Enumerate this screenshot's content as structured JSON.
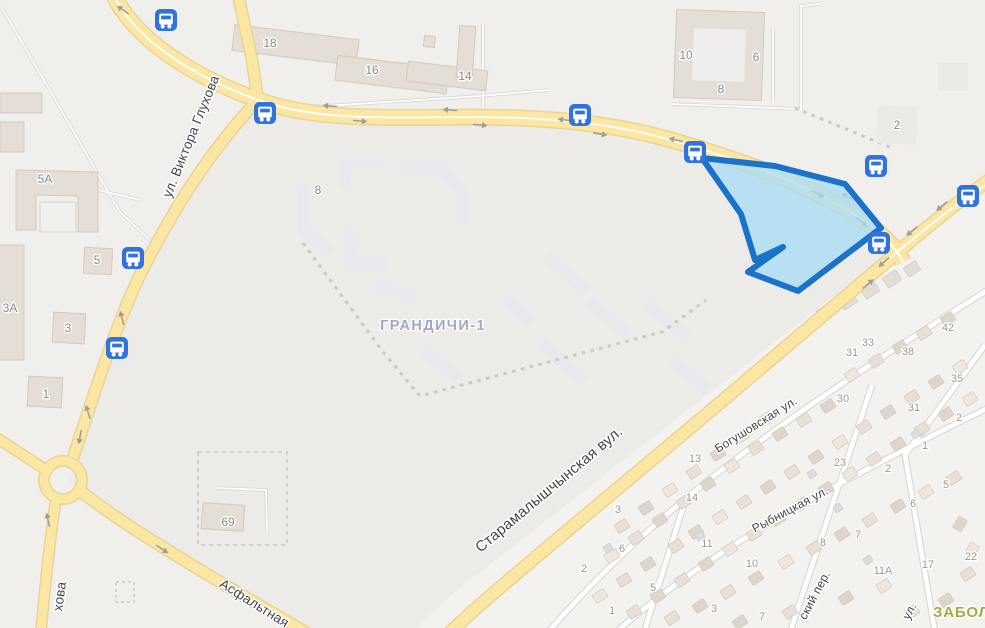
{
  "map": {
    "district_labels": [
      {
        "text": "ГРАНДИЧИ-1",
        "x": 433,
        "y": 330,
        "rotate": 0,
        "kind": "district"
      },
      {
        "text": "ЗАБОЛ",
        "x": 933,
        "y": 617,
        "rotate": 0,
        "kind": "district-green"
      }
    ],
    "street_labels": [
      {
        "text": "ул. Виктора Глухова",
        "x": 195,
        "y": 138,
        "rotate": -68,
        "size": 13.5
      },
      {
        "text": "хова",
        "x": 64,
        "y": 597,
        "rotate": -82,
        "size": 13.5
      },
      {
        "text": "Асфальтная",
        "x": 252,
        "y": 607,
        "rotate": 32,
        "size": 13.5
      },
      {
        "text": "Старамалышчынская вул.",
        "x": 552,
        "y": 493,
        "rotate": -40,
        "size": 15
      },
      {
        "text": "Богушовская ул.",
        "x": 758,
        "y": 428,
        "rotate": -32,
        "size": 12
      },
      {
        "text": "Рыбницкая ул.",
        "x": 792,
        "y": 513,
        "rotate": -28,
        "size": 12
      },
      {
        "text": "ский пер.",
        "x": 818,
        "y": 597,
        "rotate": -62,
        "size": 12
      },
      {
        "text": "ул.",
        "x": 913,
        "y": 613,
        "rotate": -62,
        "size": 12
      }
    ],
    "building_numbers": [
      [
        270,
        43,
        "18"
      ],
      [
        372,
        70,
        "16"
      ],
      [
        465,
        76,
        "14"
      ],
      [
        686,
        55,
        "10"
      ],
      [
        756,
        57,
        "6"
      ],
      [
        721,
        89,
        "8"
      ],
      [
        897,
        125,
        "2"
      ],
      [
        318,
        190,
        "8"
      ],
      [
        45,
        179,
        "5А"
      ],
      [
        97,
        260,
        "5"
      ],
      [
        10,
        308,
        "3А"
      ],
      [
        68,
        328,
        "3"
      ],
      [
        46,
        394,
        "1"
      ],
      [
        228,
        522,
        "69"
      ]
    ],
    "house_numbers": [
      [
        618,
        509,
        "3"
      ],
      [
        695,
        458,
        "13"
      ],
      [
        692,
        497,
        "14"
      ],
      [
        707,
        543,
        "11"
      ],
      [
        622,
        548,
        "6"
      ],
      [
        584,
        568,
        "2"
      ],
      [
        653,
        587,
        "5"
      ],
      [
        612,
        610,
        "1"
      ],
      [
        752,
        563,
        "10"
      ],
      [
        714,
        608,
        "3"
      ],
      [
        762,
        616,
        "7"
      ],
      [
        948,
        327,
        "42"
      ],
      [
        868,
        342,
        "33"
      ],
      [
        852,
        352,
        "31"
      ],
      [
        908,
        351,
        "38"
      ],
      [
        957,
        378,
        "35"
      ],
      [
        843,
        398,
        "30"
      ],
      [
        914,
        407,
        "31"
      ],
      [
        840,
        462,
        "23"
      ],
      [
        959,
        417,
        "2"
      ],
      [
        925,
        445,
        "1"
      ],
      [
        888,
        468,
        "2"
      ],
      [
        823,
        542,
        "8"
      ],
      [
        858,
        534,
        "7"
      ],
      [
        883,
        570,
        "11А"
      ],
      [
        928,
        564,
        "17"
      ],
      [
        971,
        556,
        "22"
      ],
      [
        946,
        484,
        "5"
      ],
      [
        913,
        503,
        "6"
      ]
    ],
    "bus_stops": [
      [
        166,
        20
      ],
      [
        265,
        113
      ],
      [
        580,
        115
      ],
      [
        695,
        152
      ],
      [
        876,
        166
      ],
      [
        968,
        196
      ],
      [
        879,
        243
      ],
      [
        133,
        258
      ],
      [
        117,
        348
      ]
    ],
    "lane_arrows": [
      [
        330,
        106,
        184
      ],
      [
        450,
        110,
        184
      ],
      [
        565,
        120,
        187
      ],
      [
        676,
        140,
        193
      ],
      [
        790,
        170,
        202
      ],
      [
        848,
        197,
        210
      ],
      [
        360,
        121,
        5
      ],
      [
        480,
        125,
        6
      ],
      [
        600,
        134,
        10
      ],
      [
        712,
        159,
        15
      ],
      [
        818,
        194,
        28
      ],
      [
        862,
        222,
        40
      ],
      [
        942,
        206,
        140
      ],
      [
        912,
        231,
        140
      ],
      [
        884,
        262,
        138
      ],
      [
        868,
        284,
        -40
      ],
      [
        122,
        318,
        255
      ],
      [
        88,
        412,
        253
      ],
      [
        162,
        549,
        33
      ],
      [
        123,
        10,
        215
      ],
      [
        80,
        437,
        100
      ],
      [
        48,
        520,
        258
      ]
    ],
    "houses": [
      [
        622,
        526
      ],
      [
        646,
        508
      ],
      [
        670,
        490
      ],
      [
        694,
        472
      ],
      [
        718,
        454
      ],
      [
        742,
        436
      ],
      [
        766,
        419
      ],
      [
        612,
        556
      ],
      [
        636,
        538
      ],
      [
        660,
        520
      ],
      [
        684,
        502
      ],
      [
        708,
        484
      ],
      [
        732,
        466
      ],
      [
        756,
        448
      ],
      [
        780,
        434
      ],
      [
        804,
        420
      ],
      [
        828,
        406
      ],
      [
        826,
        312,
        -33,
        16,
        12,
        3
      ],
      [
        848,
        301,
        -33,
        16,
        12,
        3
      ],
      [
        870,
        290,
        -33,
        16,
        12,
        3
      ],
      [
        892,
        279,
        -33,
        16,
        12,
        3
      ],
      [
        912,
        269,
        -33,
        14,
        11,
        3
      ],
      [
        852,
        375
      ],
      [
        876,
        361
      ],
      [
        900,
        347
      ],
      [
        924,
        333
      ],
      [
        948,
        319
      ],
      [
        600,
        596
      ],
      [
        624,
        580
      ],
      [
        648,
        564
      ],
      [
        676,
        546
      ],
      [
        696,
        532
      ],
      [
        720,
        517
      ],
      [
        744,
        502
      ],
      [
        768,
        487
      ],
      [
        792,
        472
      ],
      [
        816,
        457
      ],
      [
        840,
        442
      ],
      [
        864,
        427
      ],
      [
        888,
        412
      ],
      [
        912,
        397
      ],
      [
        936,
        382
      ],
      [
        960,
        367
      ],
      [
        634,
        612
      ],
      [
        658,
        596
      ],
      [
        682,
        580
      ],
      [
        706,
        564
      ],
      [
        730,
        549
      ],
      [
        754,
        534
      ],
      [
        778,
        519
      ],
      [
        802,
        504
      ],
      [
        826,
        489
      ],
      [
        850,
        474
      ],
      [
        874,
        459
      ],
      [
        898,
        444
      ],
      [
        922,
        429
      ],
      [
        946,
        414
      ],
      [
        970,
        399
      ],
      [
        672,
        618
      ],
      [
        700,
        606
      ],
      [
        728,
        592
      ],
      [
        756,
        578
      ],
      [
        786,
        562
      ],
      [
        814,
        548
      ],
      [
        842,
        534
      ],
      [
        870,
        520
      ],
      [
        898,
        506
      ],
      [
        926,
        492
      ],
      [
        954,
        478
      ],
      [
        740,
        622
      ],
      [
        790,
        612
      ],
      [
        846,
        598
      ],
      [
        884,
        586
      ],
      [
        912,
        612
      ],
      [
        946,
        600
      ],
      [
        968,
        574
      ],
      [
        960,
        524,
        -60
      ],
      [
        972,
        550,
        -60
      ],
      [
        608,
        548,
        -33,
        8,
        7,
        4
      ],
      [
        700,
        536,
        -33,
        8,
        7,
        4
      ],
      [
        812,
        474,
        -33,
        8,
        7,
        4
      ],
      [
        838,
        508,
        -33,
        8,
        7,
        4
      ],
      [
        916,
        434,
        -33,
        8,
        7,
        4
      ],
      [
        868,
        560,
        -33,
        8,
        7,
        4
      ]
    ],
    "colors": {
      "land": "#f1efec",
      "superblock_tint": "#ecebe8",
      "cottage_tint": "#f4f2ee",
      "road_yellow": "#fbe7a3",
      "road_yellow_casing": "#e9d494",
      "road_white": "#ffffff",
      "road_white_casing": "#dcd9d4",
      "building_fill": "#e5ded6",
      "building_stroke": "#d2cac1",
      "faint_building": "#ebe9e6",
      "planned_building": "#e9e8ec",
      "dash": "#ccc8c2",
      "arrow": "#a19e9a",
      "bus_stop": "#3173dc",
      "selection_fill": "#aadcf5",
      "selection_stroke": "#1a73c9",
      "house_shades": [
        "#e8e0d7",
        "#ded6cd",
        "#efe7de",
        "#e1deda",
        "#d9dee5"
      ]
    }
  }
}
